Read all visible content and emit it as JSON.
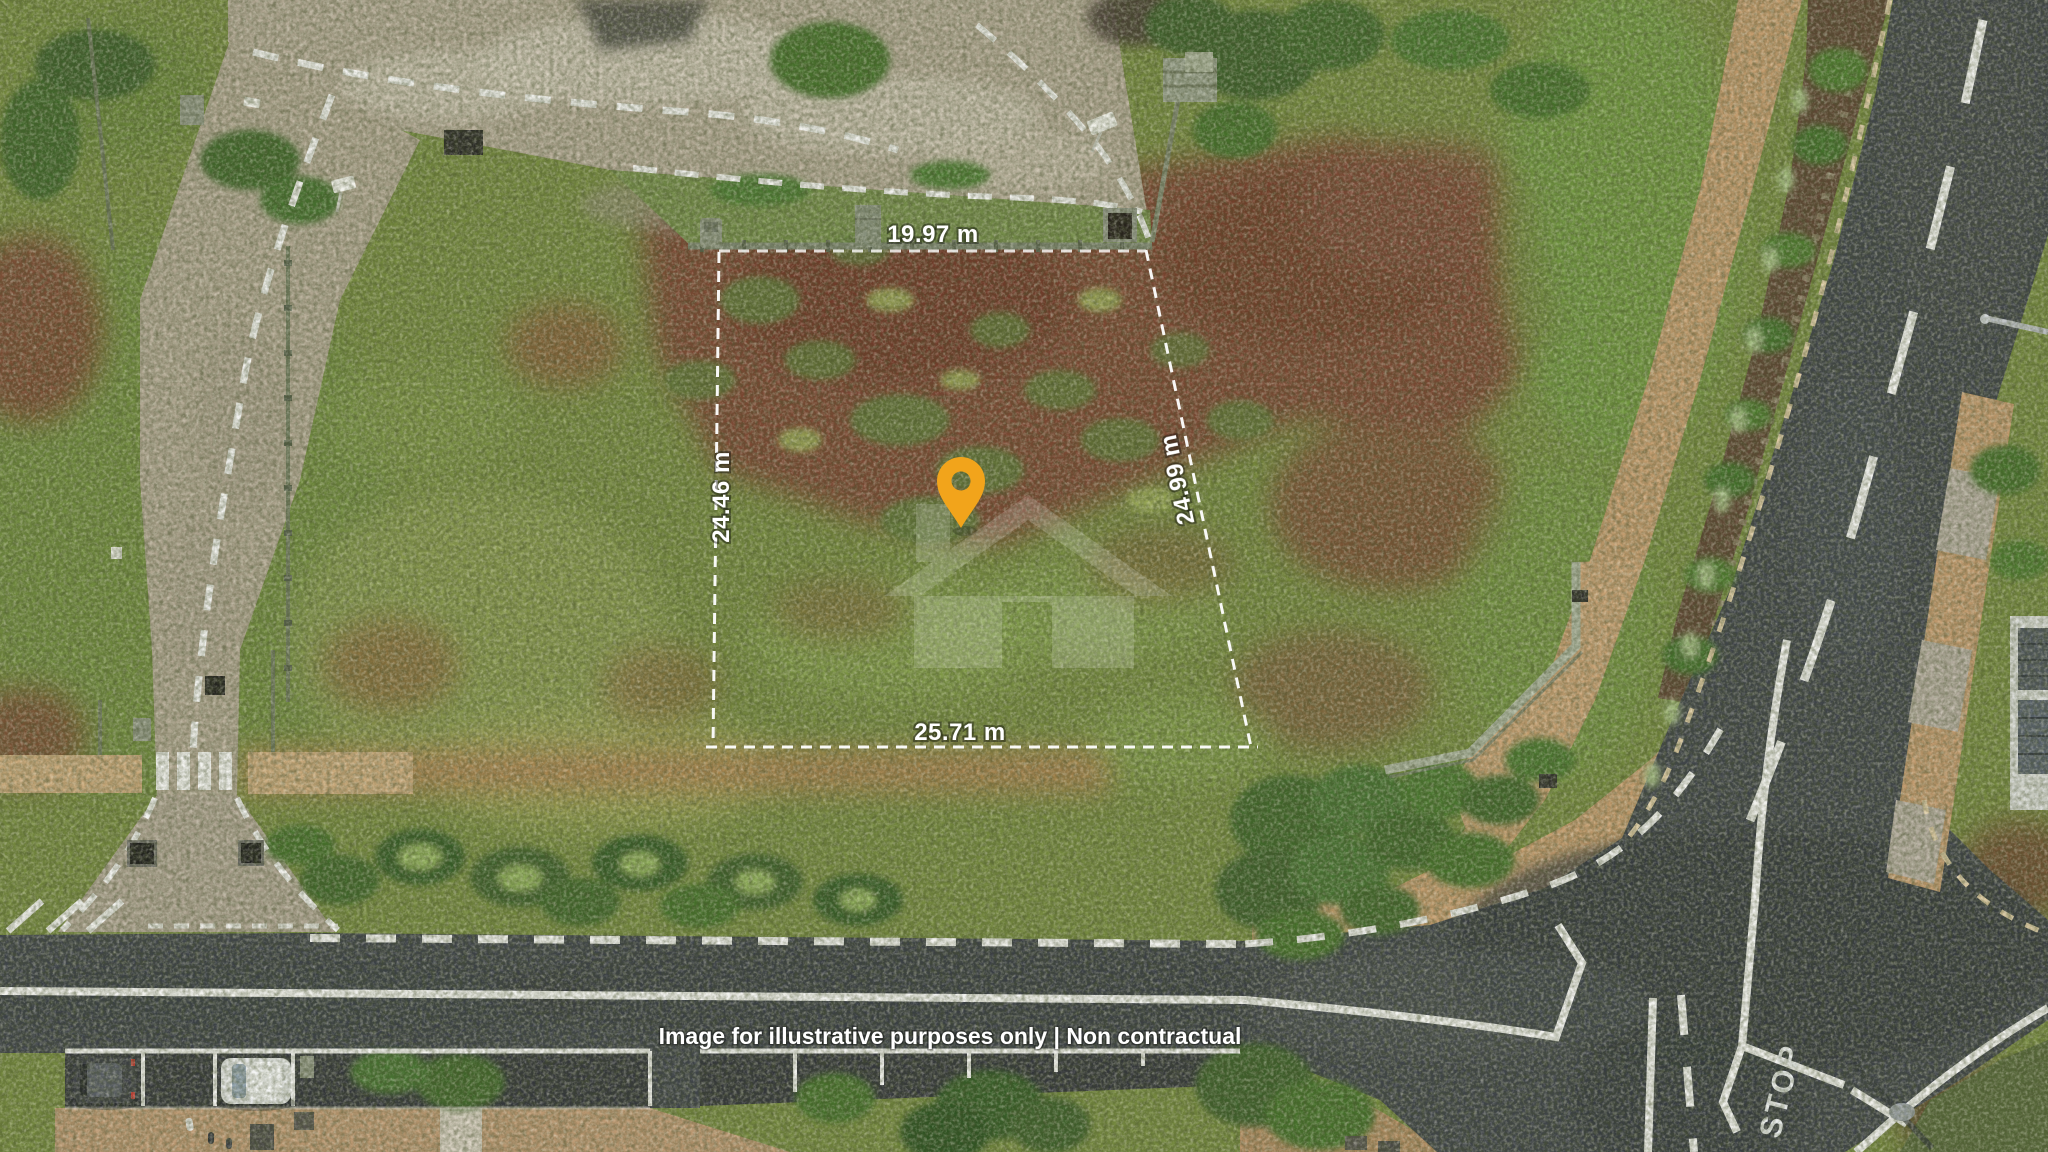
{
  "plot": {
    "top_length_label": "19.97 m",
    "left_length_label": "24.46 m",
    "right_length_label": "24.99 m",
    "bottom_length_label": "25.71 m",
    "boundary_color": "#FFFFFF",
    "pin_icon": "location-pin",
    "pin_color": "#F2A41B"
  },
  "road_markings": {
    "stop_label": "STOP",
    "paint_color": "#F2F2F0"
  },
  "watermark": {
    "icon": "house-watermark",
    "color": "#FFFFFF"
  },
  "footer": {
    "disclaimer": "Image for illustrative purposes only | Non contractual"
  }
}
